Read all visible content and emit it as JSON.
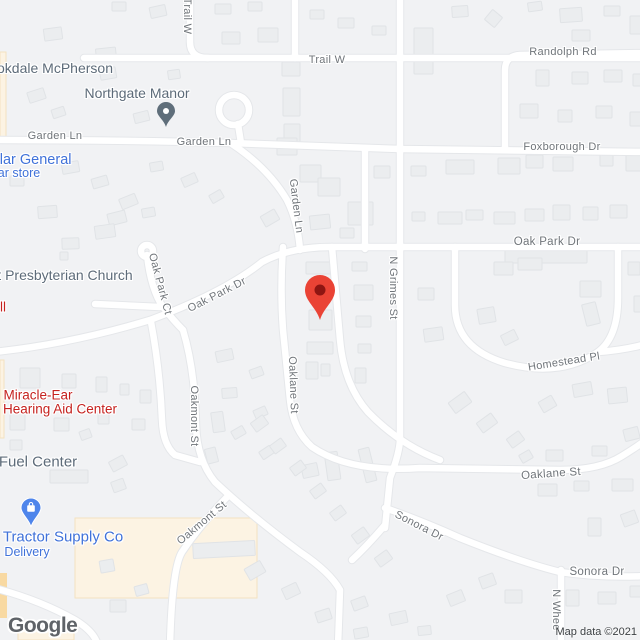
{
  "map": {
    "colors": {
      "background": "#f1f2f4",
      "road": "#ffffff",
      "road_casing": "#e5e7ea",
      "building": "#ebedef",
      "building_stroke": "#e0e3e6",
      "commercial_area": "#fcf3e3",
      "commercial_stroke": "#f4e2c0",
      "commercial_bright": "#f8d9a2",
      "street_label": "#70757a",
      "poi_gray": "#5d6b79",
      "poi_red": "#c5221f",
      "poi_blue": "#4072d9",
      "selected_pin": "#EA4335",
      "selected_pin_inner": "#8E1512",
      "northgate_pin": "#5F6E7A",
      "tractor_pin": "#4E85EB",
      "logo": "#5f6368",
      "attribution": "#3c4043"
    },
    "street_labels": [
      {
        "name": "trail-w-vertical",
        "text": "Trail W",
        "x": 187,
        "y": 16,
        "rot": 90,
        "size": 11
      },
      {
        "name": "trail-w",
        "text": "Trail W",
        "x": 327,
        "y": 60,
        "rot": 0,
        "size": 11
      },
      {
        "name": "randolph-rd",
        "text": "Randolph Rd",
        "x": 563,
        "y": 52,
        "rot": 0,
        "size": 11
      },
      {
        "name": "foxborough-dr",
        "text": "Foxborough Dr",
        "x": 562,
        "y": 147,
        "rot": 0,
        "size": 11
      },
      {
        "name": "garden-ln-west",
        "text": "Garden Ln",
        "x": 55,
        "y": 136,
        "rot": 0,
        "size": 11
      },
      {
        "name": "garden-ln-mid",
        "text": "Garden Ln",
        "x": 204,
        "y": 142,
        "rot": 0,
        "size": 11
      },
      {
        "name": "garden-ln-diag",
        "text": "Garden Ln",
        "x": 296,
        "y": 206,
        "rot": 83,
        "size": 11
      },
      {
        "name": "oak-park-dr-diag",
        "text": "Oak Park Dr",
        "x": 217,
        "y": 295,
        "rot": -27,
        "size": 11
      },
      {
        "name": "oak-park-dr",
        "text": "Oak Park Dr",
        "x": 547,
        "y": 242,
        "rot": 0,
        "size": 11.5
      },
      {
        "name": "oak-park-ct",
        "text": "Oak Park Ct",
        "x": 160,
        "y": 284,
        "rot": 75,
        "size": 11
      },
      {
        "name": "n-grimes-st",
        "text": "N Grimes St",
        "x": 393,
        "y": 288,
        "rot": 90,
        "size": 11
      },
      {
        "name": "homestead-pl",
        "text": "Homestead Pl",
        "x": 564,
        "y": 362,
        "rot": -9,
        "size": 11
      },
      {
        "name": "oaklane-st-vertical",
        "text": "Oaklane St",
        "x": 293,
        "y": 385,
        "rot": 88,
        "size": 11
      },
      {
        "name": "oaklane-st",
        "text": "Oaklane St",
        "x": 551,
        "y": 474,
        "rot": -4,
        "size": 11.5
      },
      {
        "name": "oakmont-st-vertical",
        "text": "Oakmont St",
        "x": 194,
        "y": 416,
        "rot": 90,
        "size": 11
      },
      {
        "name": "oakmont-st-diag",
        "text": "Oakmont St",
        "x": 202,
        "y": 523,
        "rot": -40,
        "size": 11
      },
      {
        "name": "sonora-dr-diag",
        "text": "Sonora Dr",
        "x": 419,
        "y": 526,
        "rot": 27,
        "size": 11
      },
      {
        "name": "sonora-dr",
        "text": "Sonora Dr",
        "x": 597,
        "y": 572,
        "rot": 0,
        "size": 11.5
      },
      {
        "name": "n-wheeler-st",
        "text": "N Whee",
        "x": 556,
        "y": 610,
        "rot": 90,
        "size": 11
      }
    ],
    "poi_labels": [
      {
        "name": "brookdale-mcpherson",
        "text": "okdale McPherson",
        "x": 55,
        "y": 68,
        "color": "gray",
        "size": 14
      },
      {
        "name": "northgate-manor",
        "text": "Northgate Manor",
        "x": 137,
        "y": 93,
        "color": "gray",
        "size": 14
      },
      {
        "name": "presbyterian-church",
        "text": "t Presbyterian Church",
        "x": 65,
        "y": 275,
        "color": "gray",
        "size": 14
      },
      {
        "name": "shell-partial",
        "text": "ll",
        "x": 3,
        "y": 307,
        "color": "red",
        "size": 13.5
      },
      {
        "name": "dollar-general",
        "text": "llar General",
        "x": 34,
        "y": 160,
        "color": "blue",
        "size": 14.5
      },
      {
        "name": "dollar-store",
        "text": "ar store",
        "x": 19,
        "y": 173,
        "color": "blue",
        "size": 12.5
      },
      {
        "name": "miracle-ear",
        "text": "Miracle-Ear",
        "x": 38,
        "y": 395,
        "color": "red",
        "size": 13.5
      },
      {
        "name": "hearing-aid-center",
        "text": "Hearing Aid Center",
        "x": 60,
        "y": 409,
        "color": "red",
        "size": 13.5
      },
      {
        "name": "fuel-center",
        "text": "Fuel Center",
        "x": 38,
        "y": 462,
        "color": "gray",
        "size": 15
      },
      {
        "name": "tractor-supply-co",
        "text": "Tractor Supply Co",
        "x": 63,
        "y": 537,
        "color": "blue",
        "size": 15
      },
      {
        "name": "tractor-delivery",
        "text": "Delivery",
        "x": 27,
        "y": 552,
        "color": "blue",
        "size": 12.5
      }
    ],
    "markers": {
      "selected_location": {
        "x": 320,
        "y": 320
      },
      "northgate_manor_pin": {
        "x": 166,
        "y": 127
      },
      "tractor_supply_pin": {
        "x": 31,
        "y": 527,
        "icon": "shopping-bag-icon"
      }
    },
    "attribution": {
      "logo_text": "Google",
      "map_data_text": "Map data ©2021"
    }
  }
}
